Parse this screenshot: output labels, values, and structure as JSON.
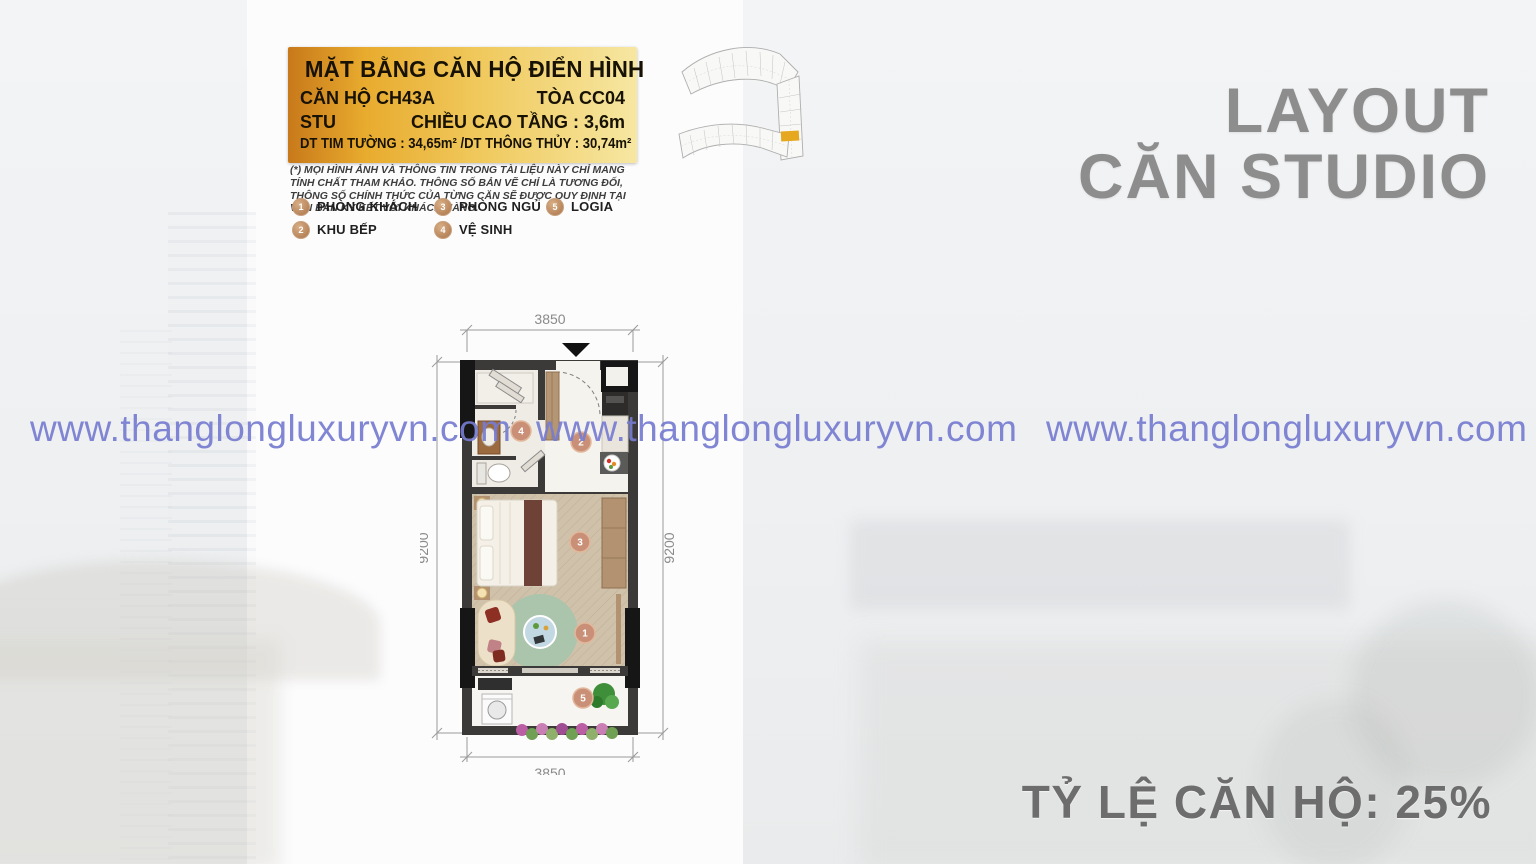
{
  "slide": {
    "side_title_line1": "LAYOUT",
    "side_title_line2": "CĂN STUDIO",
    "bottom_right_label": "TỶ LỆ CĂN HỘ: 25%",
    "watermark_text": "www.thanglongluxuryvn.com"
  },
  "header_box": {
    "title": "MẶT BẰNG CĂN HỘ ĐIỂN HÌNH",
    "unit_label": "CĂN HỘ CH43A",
    "tower_label": "TÒA CC04",
    "type_label": "STU",
    "floor_height_label": "CHIỀU CAO TẦNG : 3,6m",
    "area_label": "DT TIM TƯỜNG : 34,65m² /DT THÔNG THỦY : 30,74m²"
  },
  "disclaimer_text": "(*) MỌI HÌNH ẢNH VÀ THÔNG TIN TRONG TÀI LIỆU NÀY CHỈ MANG TÍNH CHẤT THAM KHẢO. THÔNG SỐ BẢN VẼ CHỈ LÀ TƯƠNG ĐỐI, THÔNG SỐ CHÍNH THỨC CỦA TỪNG CĂN SẼ ĐƯỢC QUY ĐỊNH TẠI VĂN BẢN KÝ KẾT VỚI KHÁCH HÀNG.",
  "legend": {
    "items": [
      {
        "num": "1",
        "label": "PHÒNG KHÁCH"
      },
      {
        "num": "2",
        "label": "KHU BẾP"
      },
      {
        "num": "3",
        "label": "PHÒNG NGỦ"
      },
      {
        "num": "4",
        "label": "VỆ SINH"
      },
      {
        "num": "5",
        "label": "LOGIA"
      }
    ]
  },
  "floor_plan": {
    "dim_top": "3850",
    "dim_bottom": "3850",
    "dim_left": "9200",
    "dim_right": "9200",
    "markers": [
      "1",
      "2",
      "3",
      "4",
      "5"
    ]
  },
  "colors": {
    "gold_gradient_start": "#c8791a",
    "gold_gradient_end": "#f6e7a2",
    "watermark": "#767cd0",
    "side_title_gray": "#8d8d8d",
    "marker_fill": "#c99077",
    "highlighted_unit": "#e6a81f",
    "wall_dark": "#3c3a38"
  }
}
